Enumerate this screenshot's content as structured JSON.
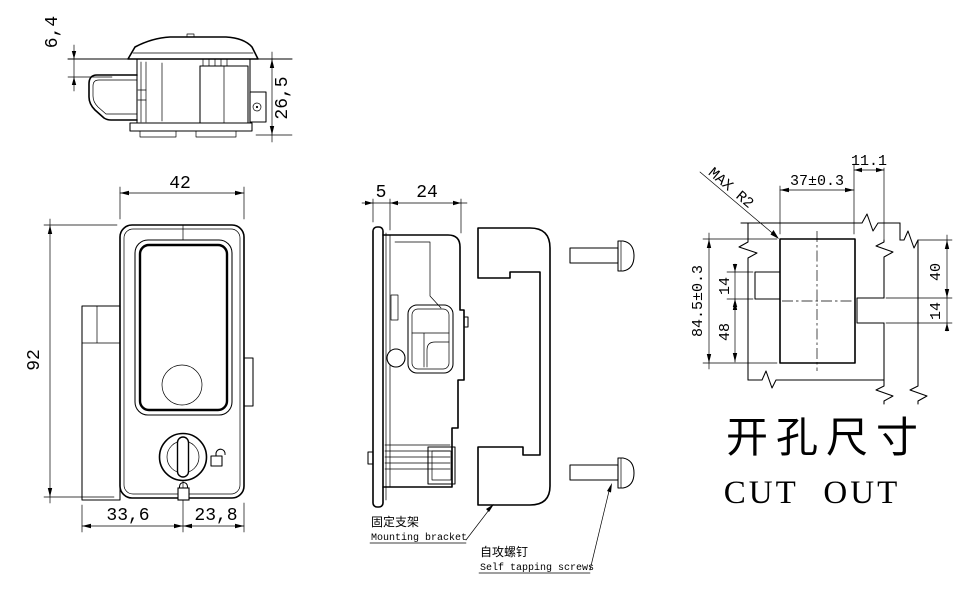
{
  "views": {
    "side": {
      "dims": {
        "cap_height": "6,4",
        "body_height": "26,5"
      }
    },
    "front": {
      "dims": {
        "width": "42",
        "height": "92",
        "left_to_key_center": "33,6",
        "key_center_to_edge": "23,8"
      }
    },
    "assembly": {
      "dims": {
        "flange_thickness": "5",
        "body_depth": "24"
      },
      "labels": {
        "bracket_zh": "固定支架",
        "bracket_en": "Mounting bracket",
        "screws_zh": "自攻螺钉",
        "screws_en": "Self tapping screws"
      }
    },
    "cutout": {
      "dims": {
        "width": "37±0.3",
        "right_offset": "11.1",
        "height": "84.5±0.3",
        "left_notch": "14",
        "below_notch": "48",
        "right_top": "40",
        "right_notch": "14"
      },
      "notes": {
        "max_radius": "MAX R2"
      },
      "titles": {
        "zh": "开孔尺寸",
        "en": "CUT OUT"
      }
    }
  },
  "colors": {
    "line": "#000000",
    "background": "#ffffff"
  }
}
